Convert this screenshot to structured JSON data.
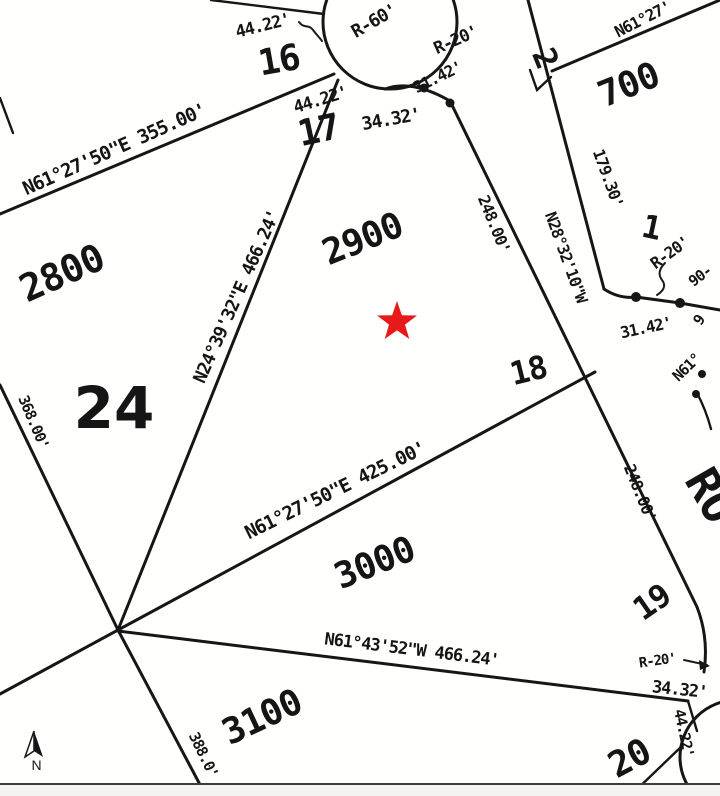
{
  "map": {
    "type": "subdivision-plat-map",
    "colors": {
      "ink": "#161616",
      "star_red": "#e8191b",
      "background": "#ffffff"
    },
    "marker": {
      "shape": "star",
      "color": "#e8191b"
    },
    "labels": {
      "d44_16": "44.22'",
      "lot16": "16",
      "r60": "R-60'",
      "r20_top": "R-20'",
      "d3142_top": "31.42'",
      "d44_17": "44.22'",
      "lot17": "17",
      "d3432_top": "34.32'",
      "lot2": "2",
      "b700_top": "N61°27'",
      "p700": "700",
      "d17930": "179.30'",
      "lot1": "1",
      "r20_right": "R-20'",
      "d90": "90-",
      "d3142_right": "31.42'",
      "frag9": "9",
      "b_n61_frag": "N61°",
      "road_name": "RO",
      "b_road": "N28°32'10\"W",
      "d248_a": "248.00'",
      "d248_b": "248.00'",
      "lot18": "18",
      "b425": "N61°27'50\"E 425.00'",
      "p3000": "3000",
      "lot19": "19",
      "b466w": "N61°43'52\"W 466.24'",
      "p3100": "3100",
      "d388": "388.0'",
      "d368": "368.00'",
      "p2800": "2800",
      "b355": "N61°27'50\"E 355.00'",
      "p24": "24",
      "b466e": "N24°39'32\"E 466.24'",
      "d44_20": "44.22'",
      "lot20": "20",
      "d3432_bot": "34.32'",
      "r20_bot": "R-20'",
      "north": "N"
    }
  }
}
